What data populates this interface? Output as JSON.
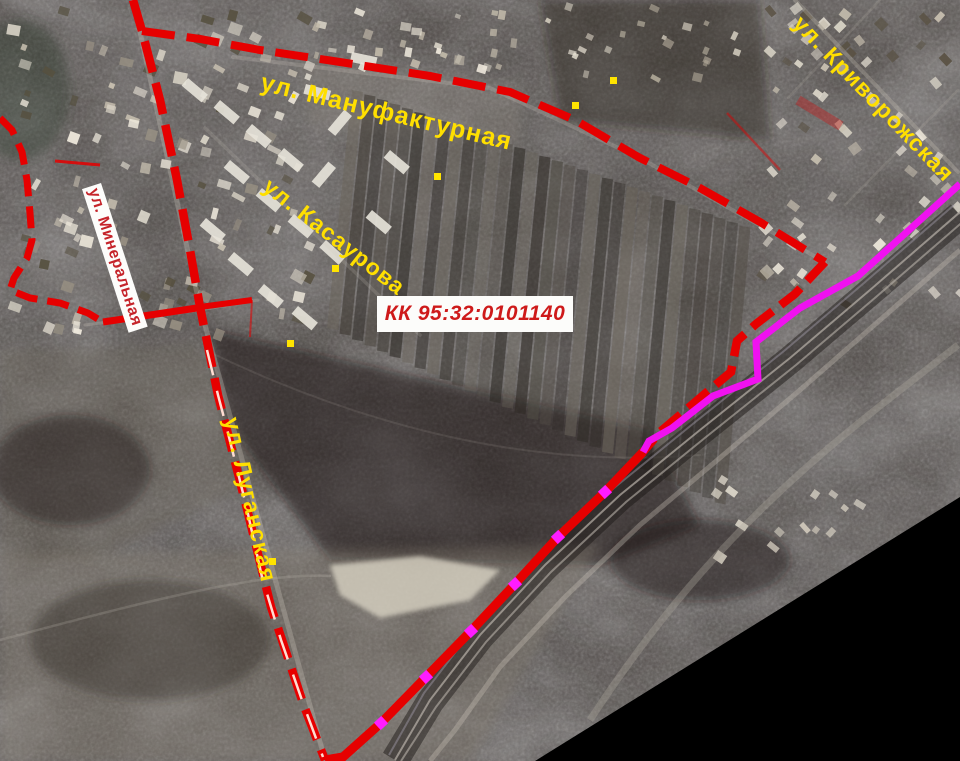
{
  "page": {
    "title": "Cadastral quarter satellite map"
  },
  "parcel": {
    "cadastral_number": "КК 95:32:0101140"
  },
  "streets": {
    "manufakturnaya": {
      "label": "ул. Мануфактурная"
    },
    "kasaurova": {
      "label": "ул. Касаурова"
    },
    "krivorozhskaya": {
      "label": "ул. Криворожская"
    },
    "luganskaya": {
      "label": "ул. Луганская"
    },
    "mineralnaya": {
      "label": "ул. Минеральная"
    }
  },
  "legend": {
    "boundary_color": "#e60000",
    "boundary_style": "dashed-red",
    "corridor_color": "#f011f0",
    "road_centerline_color": "#ffddd2",
    "street_label_color": "#ffdf00",
    "mineralnaya_label_colors": {
      "text": "#c5242a",
      "background": "#fdfdfb"
    },
    "parcel_label_colors": {
      "text": "#ce1a1a",
      "background": "#fcfcfa"
    },
    "vertex_marker_color": "#ff1cff",
    "point_marker_color": "#ffe400",
    "no_data_color": "#000000"
  }
}
